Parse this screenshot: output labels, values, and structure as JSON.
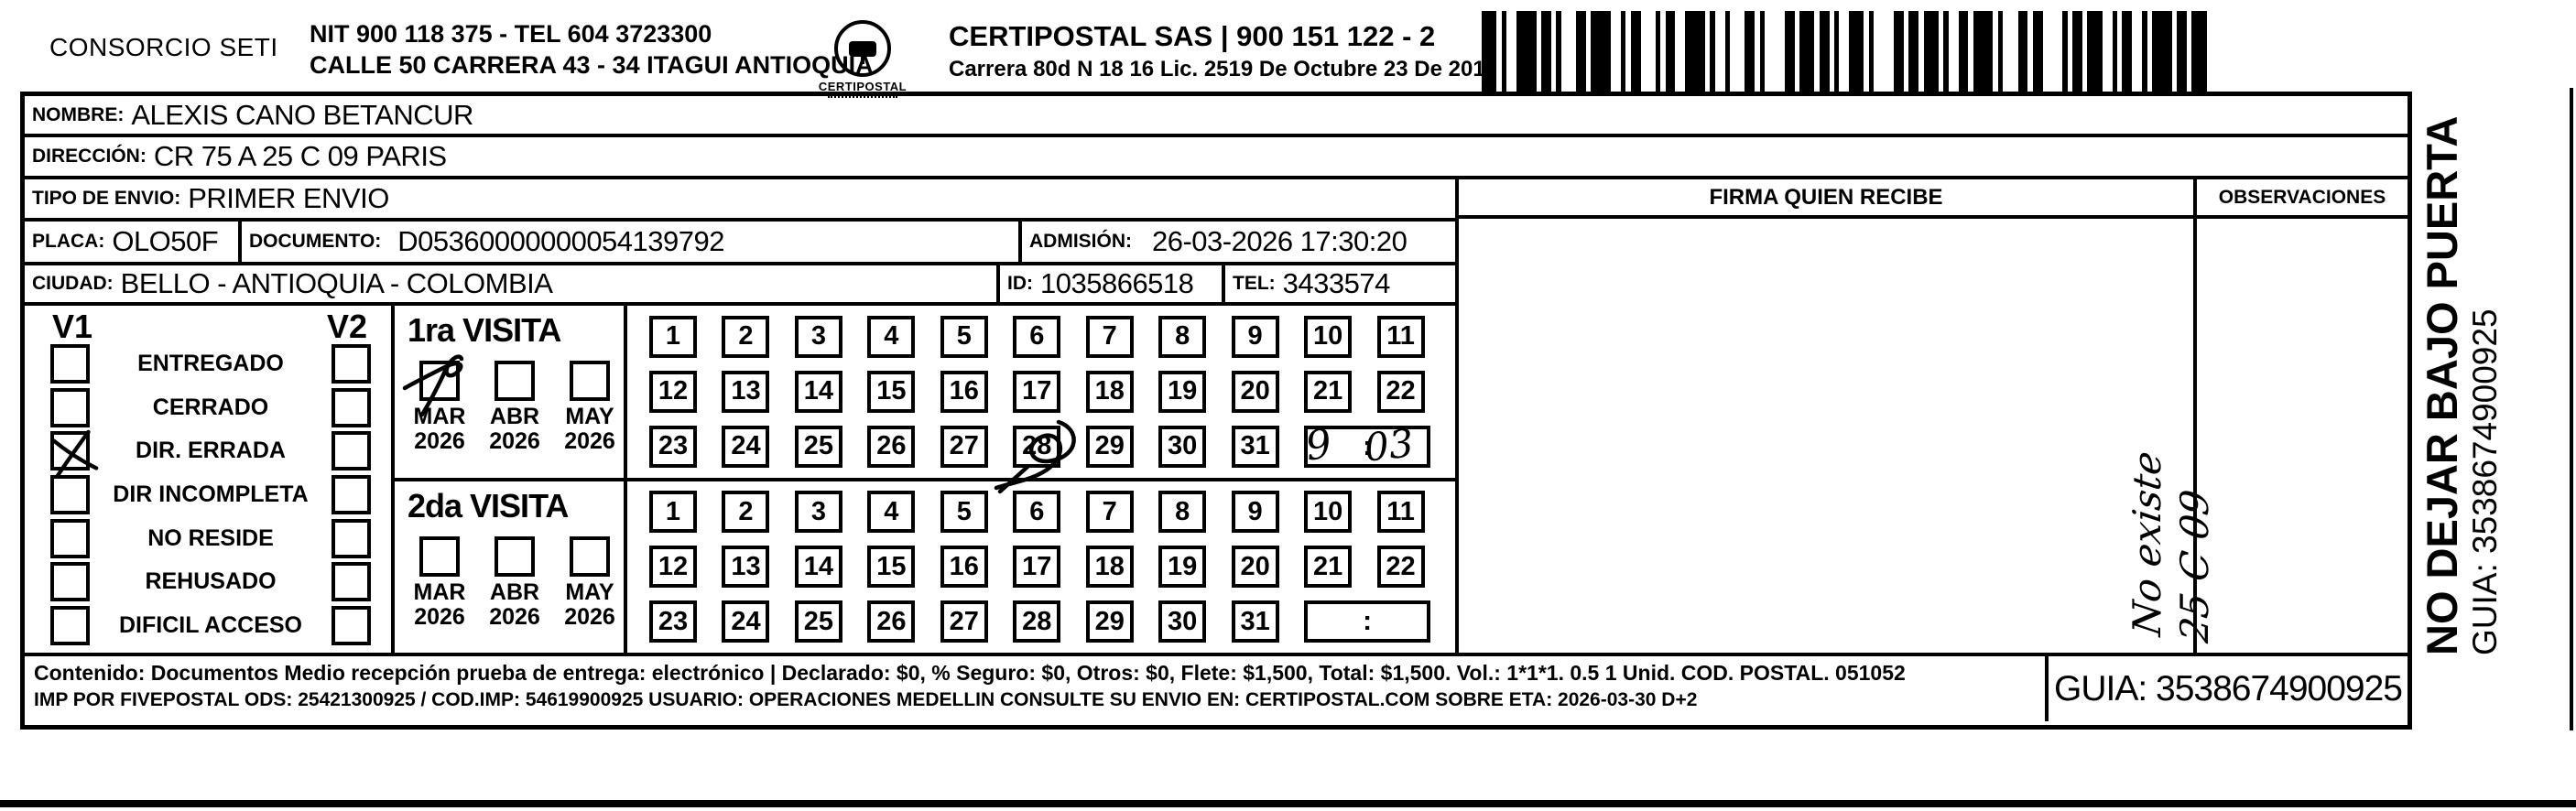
{
  "header": {
    "company": "CONSORCIO SETI",
    "nit_line": "NIT 900 118 375 - TEL 604 3723300",
    "address_line": "CALLE 50 CARRERA 43 - 34 ITAGUI ANTIOQUIA",
    "logo_text": "CERTIPOSTAL",
    "carrier": "CERTIPOSTAL SAS | 900 151 122 - 2",
    "carrier_address": "Carrera 80d N 18 16  Lic. 2519 De Octubre 23 De 2015"
  },
  "shipment": {
    "nombre_label": "NOMBRE:",
    "nombre": "ALEXIS CANO BETANCUR",
    "direccion_label": "DIRECCIÓN:",
    "direccion": "CR 75 A 25 C 09 PARIS",
    "tipo_label": "TIPO DE ENVIO:",
    "tipo": "PRIMER ENVIO",
    "placa_label": "PLACA:",
    "placa": "OLO50F",
    "documento_label": "DOCUMENTO:",
    "documento": "D05360000000054139792",
    "admision_label": "ADMISIÓN:",
    "admision": "26-03-2026 17:30:20",
    "ciudad_label": "CIUDAD:",
    "ciudad": "BELLO - ANTIOQUIA - COLOMBIA",
    "id_label": "ID:",
    "id": "1035866518",
    "tel_label": "TEL:",
    "tel": "3433574"
  },
  "status_panel": {
    "v1": "V1",
    "v2": "V2",
    "options": [
      "ENTREGADO",
      "CERRADO",
      "DIR. ERRADA",
      "DIR INCOMPLETA",
      "NO RESIDE",
      "REHUSADO",
      "DIFICIL ACCESO"
    ],
    "v1_checked_index": 2
  },
  "day_rows": [
    [
      1,
      2,
      3,
      4,
      5,
      6,
      7,
      8,
      9,
      10,
      11
    ],
    [
      12,
      13,
      14,
      15,
      16,
      17,
      18,
      19,
      20,
      21,
      22
    ],
    [
      23,
      24,
      25,
      26,
      27,
      28,
      29,
      30,
      31
    ]
  ],
  "time_colon": ":",
  "visits": [
    {
      "title": "1ra VISITA",
      "months": [
        "MAR",
        "ABR",
        "MAY"
      ],
      "years": [
        "2026",
        "2026",
        "2026"
      ],
      "checked_month_index": 0,
      "scribbled_day": 28,
      "time_written": "9:03"
    },
    {
      "title": "2da VISITA",
      "months": [
        "MAR",
        "ABR",
        "MAY"
      ],
      "years": [
        "2026",
        "2026",
        "2026"
      ],
      "checked_month_index": -1,
      "scribbled_day": null,
      "time_written": null
    }
  ],
  "right_panel": {
    "firma_header": "FIRMA QUIEN RECIBE",
    "observaciones_header": "OBSERVACIONES",
    "note_line1": "No existe",
    "note_line2": "25 C 09"
  },
  "side_text": {
    "line1": "NO DEJAR BAJO PUERTA",
    "line2": "GUIA: 3538674900925"
  },
  "footer": {
    "line1": "Contenido: Documentos Medio recepción prueba de entrega: electrónico | Declarado: $0, % Seguro: $0, Otros: $0, Flete: $1,500, Total: $1,500. Vol.: 1*1*1. 0.5  1 Unid. COD. POSTAL. 051052",
    "line2": "IMP POR FIVEPOSTAL ODS: 25421300925 / COD.IMP: 54619900925 USUARIO: OPERACIONES MEDELLIN CONSULTE SU ENVIO EN: CERTIPOSTAL.COM SOBRE ETA: 2026-03-30 D+2",
    "guia": "GUIA: 3538674900925"
  }
}
